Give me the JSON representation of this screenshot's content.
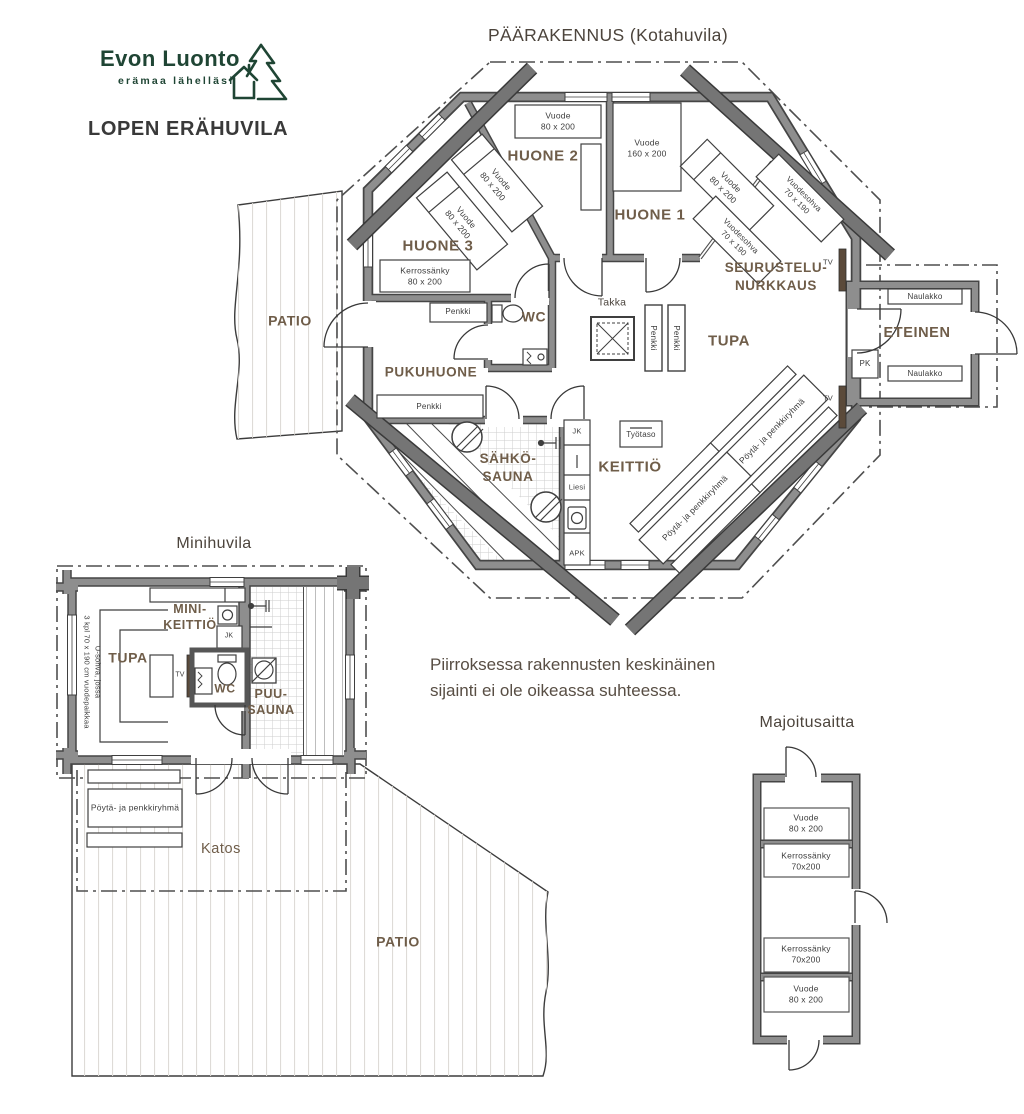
{
  "brand": {
    "name": "Evon Luonto",
    "tagline": "erämaa lähelläsi",
    "plan_title": "LOPEN ERÄHUVILA"
  },
  "buildings": {
    "main": "PÄÄRAKENNUS (Kotahuvila)",
    "mini": "Minihuvila",
    "aitta": "Majoitusaitta"
  },
  "note": "Piirroksessa rakennusten keskinäinen\nsijainti ei ole oikeassa suhteessa.",
  "rooms": {
    "huone1": "HUONE 1",
    "huone2": "HUONE 2",
    "huone3": "HUONE 3",
    "seurustelu": "SEURUSTELU-\nNURKKAUS",
    "tupa": "TUPA",
    "eteinen": "ETEINEN",
    "wc": "WC",
    "pukuhuone": "PUKUHUONE",
    "sahkosauna": "SÄHKÖ-\nSAUNA",
    "keittio": "KEITTIÖ",
    "patio": "PATIO",
    "minikeittio": "MINI-\nKEITTIÖ",
    "puusauna": "PUU-\nSAUNA",
    "katos": "Katos",
    "takka": "Takka"
  },
  "furniture": {
    "vuode80": "Vuode\n80 x 200",
    "vuode160": "Vuode\n160 x 200",
    "vuodesohva": "Vuodesohva\n70 x 190",
    "kerrossanky80": "Kerrossänky\n80 x 200",
    "kerrossanky70": "Kerrossänky\n70x200",
    "penkki": "Penkki",
    "naulakko": "Naulakko",
    "poytaryhma": "Pöytä- ja penkkiryhmä",
    "tyotaso": "Työtaso",
    "usohva": "U-sohva, jossa\n3 kpl 70 x 190 cm vuodepaikkaa",
    "jk": "JK",
    "liesi": "Liesi",
    "apk": "APK",
    "pk": "PK",
    "tv": "TV"
  },
  "colors": {
    "wall_gray": "#8e8e8e",
    "wall_edge": "#454545",
    "beam_gray": "#757575",
    "room_text": "#6f5d49",
    "dark_text": "#3c3c3c",
    "brand_green": "#1f4534",
    "tv_brown": "#5b4a3a"
  }
}
